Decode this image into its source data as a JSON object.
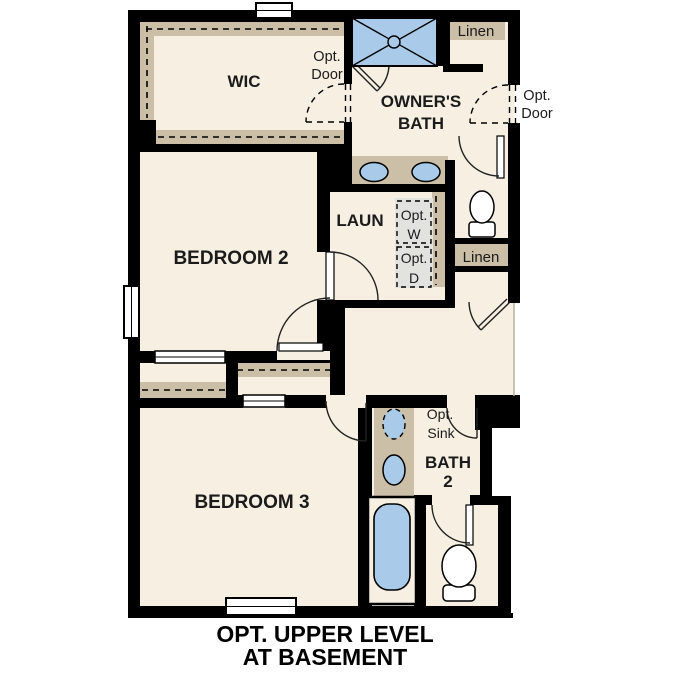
{
  "plan": {
    "caption": {
      "line1": "OPT. UPPER LEVEL",
      "line2": "AT BASEMENT"
    },
    "rooms": {
      "wic": "WIC",
      "owners_bath_line1": "OWNER'S",
      "owners_bath_line2": "BATH",
      "laundry": "LAUN",
      "bedroom2": "BEDROOM 2",
      "bedroom3": "BEDROOM 3",
      "bath2_line1": "BATH",
      "bath2_line2": "2",
      "linen_top": "Linen",
      "linen_mid": "Linen"
    },
    "options": {
      "door_wic": [
        "Opt.",
        "Door"
      ],
      "door_bath": [
        "Opt.",
        "Door"
      ],
      "washer": [
        "Opt.",
        "W"
      ],
      "dryer": [
        "Opt.",
        "D"
      ],
      "sink": [
        "Opt.",
        "Sink"
      ]
    },
    "colors": {
      "floor": "#f6efe2",
      "wall_accent_tan": "#cbbfa8",
      "fixture_blue": "#a9cbe9",
      "optional_grey": "#e2e3de",
      "wall_black": "#000000",
      "background": "#ffffff"
    }
  }
}
